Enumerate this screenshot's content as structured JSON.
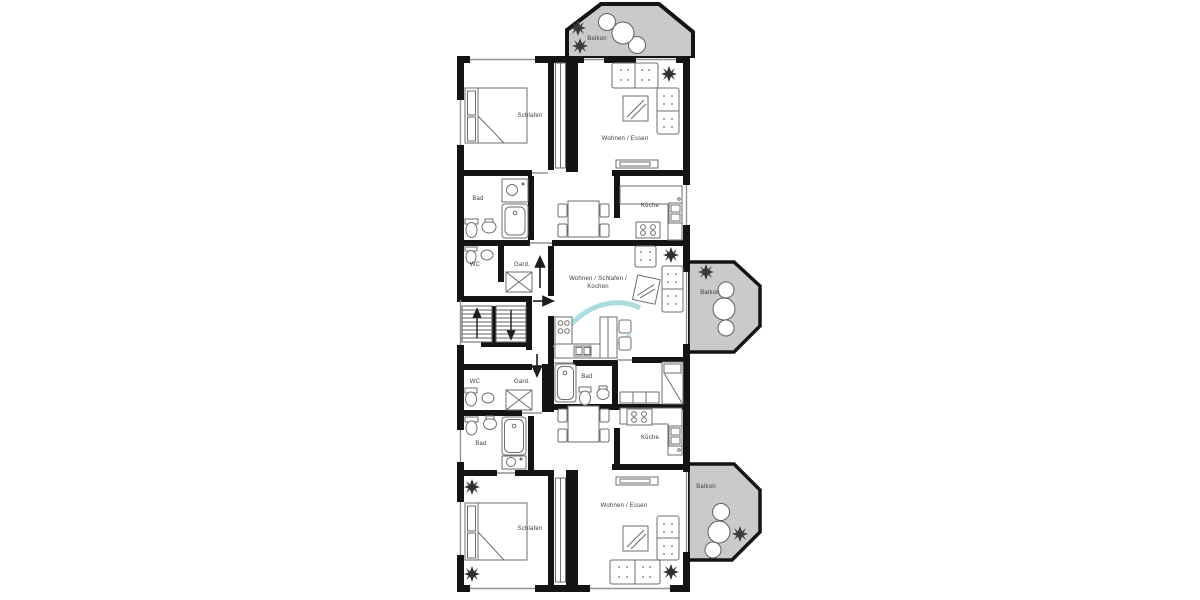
{
  "colors": {
    "wall": "#141414",
    "balcony_fill": "#cacaca",
    "furniture_line": "#6e6e6e",
    "accent_teal": "#8ed2d1",
    "label": "#3c3c3c",
    "background": "#ffffff"
  },
  "floorplan": {
    "apartment_top": {
      "balkon": "Balkon",
      "schlafen": "Schlafen",
      "wohnen_essen": "Wohnen / Essen",
      "bad": "Bad",
      "wc": "WC",
      "gard": "Gard.",
      "kueche": "Küche"
    },
    "apartment_middle": {
      "room_line1": "Wohnen / Schlafen /",
      "room_line2": "Kochen",
      "bad": "Bad",
      "balkon": "Balkon"
    },
    "apartment_bottom": {
      "schlafen": "Schlafen",
      "wohnen_essen": "Wohnen / Essen",
      "bad": "Bad",
      "wc": "WC",
      "gard": "Gard.",
      "kueche": "Küche",
      "balkon": "Balkon"
    }
  }
}
